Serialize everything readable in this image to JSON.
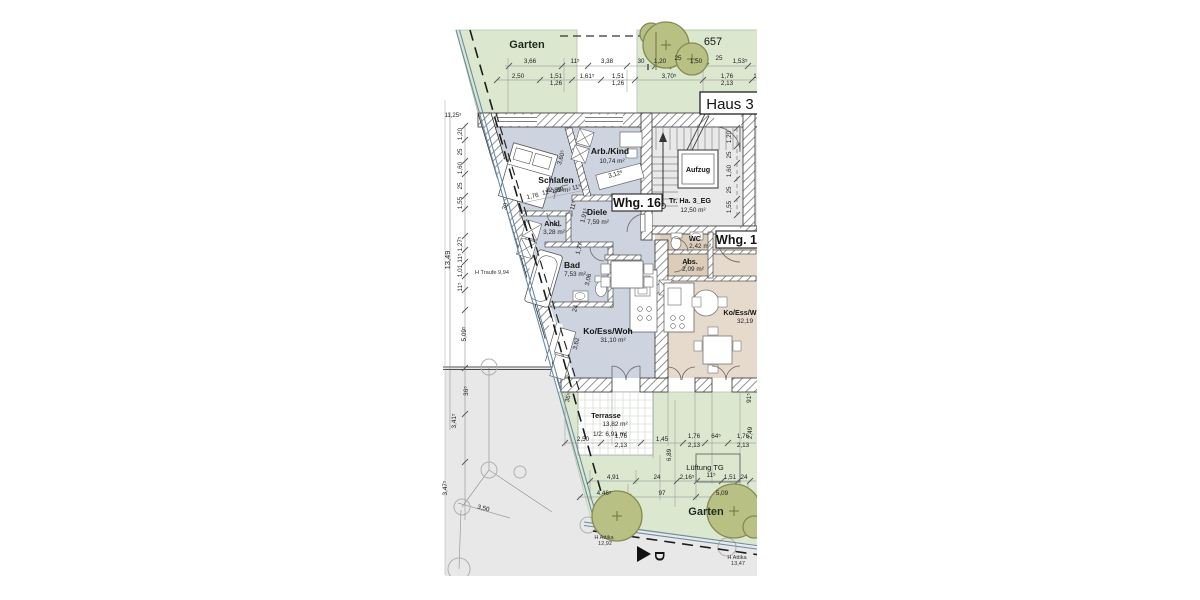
{
  "site": {
    "garden_top": "Garten",
    "garden_bottom": "Garten",
    "parcel": "657",
    "house": "Haus 3",
    "lueftung": "Lüftung TG",
    "h_traufe": "H Traufe 9,94",
    "h_attika_left_1": "H Attika",
    "h_attika_left_2": "12,92",
    "h_attika_right_1": "H Attika",
    "h_attika_right_2": "13,47",
    "section_marker": "D"
  },
  "whg16": {
    "label": "Whg. 16",
    "stair_name": "Tr. Ha. 3_EG",
    "stair_area": "12,50 m²",
    "elevator": "Aufzug",
    "schlafen": {
      "name": "Schlafen",
      "area": "12,89 m²"
    },
    "arbkind": {
      "name": "Arb./Kind",
      "area": "10,74 m²"
    },
    "ankl": {
      "name": "Ankl.",
      "area": "3,28 m²"
    },
    "diele": {
      "name": "Diele",
      "area": "7,59 m²"
    },
    "bad": {
      "name": "Bad",
      "area": "7,53 m²"
    },
    "woh": {
      "name": "Ko/Ess/Woh",
      "area": "31,10 m²"
    },
    "terrasse": {
      "name": "Terrasse",
      "area": "13,82 m²",
      "half": "1/2: 6,91 m²"
    }
  },
  "whg17": {
    "label": "Whg. 17",
    "wc": {
      "name": "WC",
      "area": "2,42 m²"
    },
    "abs": {
      "name": "Abs.",
      "area": "2,09 m²"
    },
    "woh": {
      "name": "Ko/Ess/W",
      "area": "32,19"
    }
  },
  "colors": {
    "garden": "#dbe7cf",
    "tree": "#b9c083",
    "tree_stroke": "#848a52",
    "apartment16": "#cdd4df",
    "apartment17": "#e6dacc",
    "stairwell": "#e9e9e9",
    "boundary": "#6b8ca6",
    "neighbor": "#e8e8e8"
  },
  "dim_labels": [
    {
      "t": "3,66",
      "x": 530,
      "y": 63
    },
    {
      "t": "11⁵",
      "x": 575,
      "y": 63
    },
    {
      "t": "3,38",
      "x": 607,
      "y": 63
    },
    {
      "t": "30",
      "x": 641,
      "y": 63
    },
    {
      "t": "1,20",
      "x": 660,
      "y": 63
    },
    {
      "t": "25",
      "x": 678,
      "y": 60
    },
    {
      "t": "1,50",
      "x": 696,
      "y": 63
    },
    {
      "t": "25",
      "x": 719,
      "y": 60
    },
    {
      "t": "1,53⁵",
      "x": 740,
      "y": 63
    },
    {
      "t": "2,50",
      "x": 518,
      "y": 78
    },
    {
      "t": "1,51",
      "x": 556,
      "y": 78
    },
    {
      "t": "1,26",
      "x": 556,
      "y": 85
    },
    {
      "t": "1,61⁵",
      "x": 587,
      "y": 78
    },
    {
      "t": "1,51",
      "x": 618,
      "y": 78
    },
    {
      "t": "1,26",
      "x": 618,
      "y": 85
    },
    {
      "t": "3,70⁵",
      "x": 669,
      "y": 78
    },
    {
      "t": "1,76",
      "x": 727,
      "y": 78
    },
    {
      "t": "2,13",
      "x": 727,
      "y": 85
    },
    {
      "t": "1",
      "x": 755,
      "y": 78
    },
    {
      "t": "1,20",
      "x": 462,
      "y": 134,
      "r": -90
    },
    {
      "t": "25",
      "x": 462,
      "y": 152,
      "r": -90
    },
    {
      "t": "1,60",
      "x": 462,
      "y": 168,
      "r": -90
    },
    {
      "t": "25",
      "x": 462,
      "y": 186,
      "r": -90
    },
    {
      "t": "1,55",
      "x": 462,
      "y": 203,
      "r": -90
    },
    {
      "t": "30",
      "x": 507,
      "y": 207,
      "r": -73
    },
    {
      "t": "1,27⁵",
      "x": 462,
      "y": 244,
      "r": -90
    },
    {
      "t": "11⁵",
      "x": 462,
      "y": 258,
      "r": -90
    },
    {
      "t": "1,01",
      "x": 462,
      "y": 271,
      "r": -90
    },
    {
      "t": "11⁵",
      "x": 462,
      "y": 287,
      "r": -90
    },
    {
      "t": "13,49",
      "x": 450,
      "y": 260,
      "r": -90,
      "s": 7.5
    },
    {
      "t": "5,09⁵",
      "x": 466,
      "y": 334,
      "r": -90
    },
    {
      "t": "36⁵",
      "x": 468,
      "y": 391,
      "r": -90
    },
    {
      "t": "3,41⁵",
      "x": 456,
      "y": 421,
      "r": -90
    },
    {
      "t": "3,47⁵",
      "x": 447,
      "y": 488,
      "r": -90
    },
    {
      "t": "11,25⁵",
      "x": 453,
      "y": 117,
      "s": 6
    },
    {
      "t": "1,20",
      "x": 731,
      "y": 137,
      "r": -90
    },
    {
      "t": "25",
      "x": 731,
      "y": 155,
      "r": -90
    },
    {
      "t": "1,60",
      "x": 731,
      "y": 171,
      "r": -90
    },
    {
      "t": "25",
      "x": 731,
      "y": 190,
      "r": -90
    },
    {
      "t": "1,55",
      "x": 731,
      "y": 207,
      "r": -90
    },
    {
      "t": "3,60⁵",
      "x": 563,
      "y": 158,
      "r": -73
    },
    {
      "t": "3,12⁵",
      "x": 616,
      "y": 176,
      "r": -15
    },
    {
      "t": "1,76",
      "x": 533,
      "y": 198,
      "r": -12
    },
    {
      "t": "11⁵",
      "x": 547,
      "y": 194,
      "r": -12
    },
    {
      "t": "1,09",
      "x": 558,
      "y": 192,
      "r": -12
    },
    {
      "t": "11⁵",
      "x": 577,
      "y": 189,
      "r": -12
    },
    {
      "t": "11⁵",
      "x": 575,
      "y": 206,
      "r": -75
    },
    {
      "t": "1,91⁵",
      "x": 586,
      "y": 216,
      "r": -75
    },
    {
      "t": "1,77",
      "x": 581,
      "y": 249,
      "r": -75
    },
    {
      "t": "3,06",
      "x": 590,
      "y": 280,
      "r": -78
    },
    {
      "t": "24",
      "x": 577,
      "y": 309,
      "r": -75
    },
    {
      "t": "3,62",
      "x": 578,
      "y": 344,
      "r": -78
    },
    {
      "t": "36⁵",
      "x": 570,
      "y": 398,
      "r": -75
    },
    {
      "t": "91⁵",
      "x": 751,
      "y": 398,
      "r": -90
    },
    {
      "t": "2,49",
      "x": 752,
      "y": 433,
      "r": -90
    },
    {
      "t": "6,89",
      "x": 671,
      "y": 455,
      "r": -90
    },
    {
      "t": "2,50",
      "x": 583,
      "y": 441
    },
    {
      "t": "1,76",
      "x": 621,
      "y": 438
    },
    {
      "t": "2,13",
      "x": 621,
      "y": 447
    },
    {
      "t": "1,45",
      "x": 662,
      "y": 441
    },
    {
      "t": "1,76",
      "x": 694,
      "y": 438
    },
    {
      "t": "2,13",
      "x": 694,
      "y": 447
    },
    {
      "t": "64⁵",
      "x": 716,
      "y": 438
    },
    {
      "t": "1,76",
      "x": 743,
      "y": 438
    },
    {
      "t": "2,13",
      "x": 743,
      "y": 447
    },
    {
      "t": "4,91",
      "x": 613,
      "y": 479
    },
    {
      "t": "24",
      "x": 657,
      "y": 479
    },
    {
      "t": "2,16⁵",
      "x": 687,
      "y": 479
    },
    {
      "t": "11⁵",
      "x": 711,
      "y": 477
    },
    {
      "t": "1,51",
      "x": 730,
      "y": 479
    },
    {
      "t": "24",
      "x": 744,
      "y": 479
    },
    {
      "t": "4,46⁵",
      "x": 604,
      "y": 495
    },
    {
      "t": "97",
      "x": 662,
      "y": 495
    },
    {
      "t": "5,09",
      "x": 722,
      "y": 495
    },
    {
      "t": "3,50",
      "x": 483,
      "y": 510,
      "r": 14
    }
  ]
}
